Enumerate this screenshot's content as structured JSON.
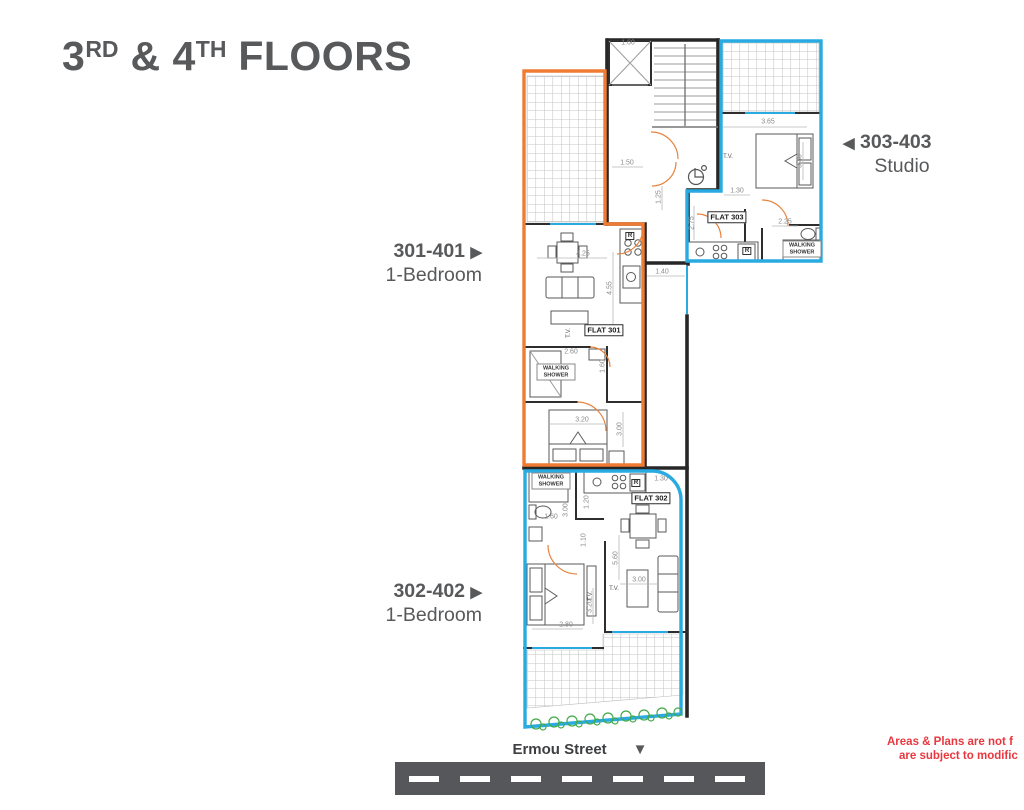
{
  "title": {
    "n1": "3",
    "s1": "RD",
    "amp": " & ",
    "n2": "4",
    "s2": "TH",
    "rest": " FLOORS"
  },
  "units": {
    "u301": {
      "id": "301-401",
      "arrow": "▶",
      "type": "1-Bedroom"
    },
    "u302": {
      "id": "302-402",
      "arrow": "▶",
      "type": "1-Bedroom"
    },
    "u303": {
      "id": "303-403",
      "arrow": "◀",
      "type": "Studio"
    }
  },
  "street": {
    "label": "Ermou Street",
    "arrow": "▼"
  },
  "disclaimer": {
    "line1": "Areas & Plans are not f",
    "line2": "are subject to modific"
  },
  "colors": {
    "accent_orange": "#EF7C32",
    "accent_blue": "#29ABE2",
    "text_gray": "#58595B",
    "disclaimer_red": "#E8373F",
    "road_gray": "#55575A",
    "shrub_green": "#44A948"
  },
  "plan": {
    "flat_labels": [
      {
        "text": "FLAT 301",
        "x": 604,
        "y": 330
      },
      {
        "text": "FLAT 302",
        "x": 651,
        "y": 498
      },
      {
        "text": "FLAT 303",
        "x": 727,
        "y": 217
      }
    ],
    "shower_labels": [
      {
        "text": "WALKING SHOWER",
        "x": 556,
        "y": 372
      },
      {
        "text": "WALKING SHOWER",
        "x": 551,
        "y": 481
      },
      {
        "text": "WALKING SHOWER",
        "x": 802,
        "y": 249
      }
    ],
    "tv_labels": [
      {
        "text": "T.V.",
        "x": 569,
        "y": 333,
        "rot": 1
      },
      {
        "text": "T.V.",
        "x": 591,
        "y": 596,
        "rot": 1
      },
      {
        "text": "T.V.",
        "x": 614,
        "y": 589
      },
      {
        "text": "T.V.",
        "x": 728,
        "y": 157
      }
    ],
    "appliance_labels": [
      {
        "text": "R",
        "x": 630,
        "y": 236
      },
      {
        "text": "R",
        "x": 636,
        "y": 483
      },
      {
        "text": "R",
        "x": 747,
        "y": 251
      }
    ],
    "dimensions": [
      {
        "text": "1.60",
        "x": 628,
        "y": 43
      },
      {
        "text": "1.50",
        "x": 627,
        "y": 163
      },
      {
        "text": "1.25",
        "x": 659,
        "y": 197,
        "rot": 1
      },
      {
        "text": "1.40",
        "x": 662,
        "y": 272
      },
      {
        "text": "3.65",
        "x": 768,
        "y": 122
      },
      {
        "text": "3.40",
        "x": 800,
        "y": 161,
        "rot": 1
      },
      {
        "text": "1.30",
        "x": 737,
        "y": 191
      },
      {
        "text": "2.75",
        "x": 692,
        "y": 223,
        "rot": 1
      },
      {
        "text": "2.25",
        "x": 785,
        "y": 222
      },
      {
        "text": "4.25",
        "x": 583,
        "y": 254
      },
      {
        "text": "4.55",
        "x": 610,
        "y": 288,
        "rot": 1
      },
      {
        "text": "2.60",
        "x": 571,
        "y": 352
      },
      {
        "text": "1.60",
        "x": 603,
        "y": 366,
        "rot": 1
      },
      {
        "text": "3.20",
        "x": 582,
        "y": 420
      },
      {
        "text": "3.00",
        "x": 620,
        "y": 429,
        "rot": 1
      },
      {
        "text": "1.30",
        "x": 661,
        "y": 479
      },
      {
        "text": "1.20",
        "x": 587,
        "y": 502,
        "rot": 1
      },
      {
        "text": "3.00",
        "x": 566,
        "y": 510,
        "rot": 1
      },
      {
        "text": "1.60",
        "x": 551,
        "y": 517
      },
      {
        "text": "1.10",
        "x": 584,
        "y": 540,
        "rot": 1
      },
      {
        "text": "5.60",
        "x": 616,
        "y": 558,
        "rot": 1
      },
      {
        "text": "3.00",
        "x": 639,
        "y": 580
      },
      {
        "text": "3.20",
        "x": 590,
        "y": 606,
        "rot": 1
      },
      {
        "text": "2.80",
        "x": 566,
        "y": 625
      }
    ]
  }
}
